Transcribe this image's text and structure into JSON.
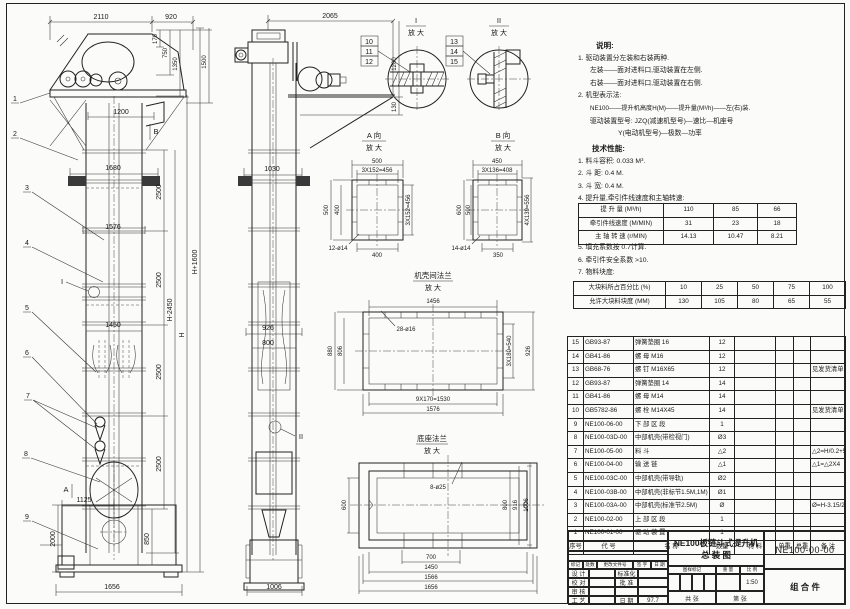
{
  "notes": {
    "title": "说明:",
    "line1": "1. 驱动装置分左装和右装两种.",
    "line2": "左装——面对进料口,驱动装置在左侧.",
    "line3": "右装——面对进料口,驱动装置在右侧.",
    "line4": "2. 机型表示法:",
    "line5": "NE100——提升机高度H(M)——提升量(M³/h)——左(右)装.",
    "line6": "驱动装置型号: JZQ(减速机型号)—速比—机座号",
    "line7": "Y(电动机型号)—极数—功率"
  },
  "tech": {
    "title": "技术性能:",
    "item1": "1. 料斗容积: 0.033 M³.",
    "item2": "2. 斗  距: 0.4 M.",
    "item3": "3. 斗  宽: 0.4 M.",
    "item4": "4. 提升量,牵引件线速度和主轴转速:",
    "item5": "5. 填充系数按 0.7计算.",
    "item6": "6. 牵引件安全系数 >10.",
    "item7": "7. 物料块度:",
    "table1": {
      "r1": {
        "label": "提 升 量  (M³/h)",
        "v1": "110",
        "v2": "85",
        "v3": "66"
      },
      "r2": {
        "label": "牵引件线速度 (M/MIN)",
        "v1": "31",
        "v2": "23",
        "v3": "18"
      },
      "r3": {
        "label": "主 轴 转 速 (r/MIN)",
        "v1": "14.13",
        "v2": "10.47",
        "v3": "8.21"
      }
    },
    "table2": {
      "r1": {
        "label": "大块料所占百分比 (%)",
        "v1": "10",
        "v2": "25",
        "v3": "50",
        "v4": "75",
        "v5": "100"
      },
      "r2": {
        "label": "允许大块料块度 (MM)",
        "v1": "130",
        "v2": "105",
        "v3": "80",
        "v4": "65",
        "v5": "55"
      }
    }
  },
  "bom": {
    "headers": {
      "no": "序号",
      "code": "代    号",
      "name": "名      称",
      "qty": "数量",
      "mat": "材    料",
      "uw": "单重",
      "tw": "总重",
      "remark": "备  注"
    },
    "rows": [
      {
        "no": "15",
        "code": "GB93-87",
        "name": "弹簧垫圈  16",
        "qty": "12",
        "mat": "",
        "uw": "",
        "tw": "",
        "remark": ""
      },
      {
        "no": "14",
        "code": "GB41-86",
        "name": "螺 母  M16",
        "qty": "12",
        "mat": "",
        "uw": "",
        "tw": "",
        "remark": ""
      },
      {
        "no": "13",
        "code": "GB68-76",
        "name": "螺 钉  M16X65",
        "qty": "12",
        "mat": "",
        "uw": "",
        "tw": "",
        "remark": "见发货清单"
      },
      {
        "no": "12",
        "code": "GB93-87",
        "name": "弹簧垫圈  14",
        "qty": "14",
        "mat": "",
        "uw": "",
        "tw": "",
        "remark": ""
      },
      {
        "no": "11",
        "code": "GB41-86",
        "name": "螺 母  M14",
        "qty": "14",
        "mat": "",
        "uw": "",
        "tw": "",
        "remark": ""
      },
      {
        "no": "10",
        "code": "GB5782-86",
        "name": "螺 栓  M14X45",
        "qty": "14",
        "mat": "",
        "uw": "",
        "tw": "",
        "remark": "见发货清单"
      },
      {
        "no": "9",
        "code": "NE100-06-00",
        "name": "下 部 区 段",
        "qty": "1",
        "mat": "",
        "uw": "",
        "tw": "",
        "remark": ""
      },
      {
        "no": "8",
        "code": "NE100-03D-00",
        "name": "中部机壳(带检视门)",
        "qty": "Ø3",
        "mat": "",
        "uw": "",
        "tw": "",
        "remark": ""
      },
      {
        "no": "7",
        "code": "NE100-05-00",
        "name": "料  斗",
        "qty": "△2",
        "mat": "",
        "uw": "",
        "tw": "",
        "remark": "△2=H/0.2+5.75"
      },
      {
        "no": "6",
        "code": "NE100-04-00",
        "name": "输 送 链",
        "qty": "△1",
        "mat": "",
        "uw": "",
        "tw": "",
        "remark": "△1=△2X4"
      },
      {
        "no": "5",
        "code": "NE100-03C-00",
        "name": "中部机壳(带导轨)",
        "qty": "Ø2",
        "mat": "",
        "uw": "",
        "tw": "",
        "remark": ""
      },
      {
        "no": "4",
        "code": "NE100-03B-00",
        "name": "中部机壳(非标节1.5M,1M)",
        "qty": "Ø1",
        "mat": "",
        "uw": "",
        "tw": "",
        "remark": ""
      },
      {
        "no": "3",
        "code": "NE100-03A-00",
        "name": "中部机壳(标准节2.5M)",
        "qty": "Ø",
        "mat": "",
        "uw": "",
        "tw": "",
        "remark": "Ø=H-3.15/2.5"
      },
      {
        "no": "2",
        "code": "NE100-02-00",
        "name": "上 部 区 段",
        "qty": "1",
        "mat": "",
        "uw": "",
        "tw": "",
        "remark": ""
      },
      {
        "no": "1",
        "code": "NE100-01-00",
        "name": "驱 动 装 置",
        "qty": "1",
        "mat": "",
        "uw": "",
        "tw": "",
        "remark": ""
      }
    ]
  },
  "title_block": {
    "product": "NE100板链斗式提升机",
    "sheet_name": "总   装   图",
    "code": "NE100-00-00",
    "part_type": "组  合  件",
    "rev_h1": "标记",
    "rev_h2": "处数",
    "rev_h3": "更改文件号",
    "rev_h4": "签 字",
    "rev_h5": "日 期",
    "l1": "设 计",
    "l2": "校 对",
    "l3": "审 核",
    "l4": "工 艺",
    "r1": "标准化",
    "r2": "批 准",
    "r3": "日 期",
    "date": "97.7",
    "m1": "图样标记",
    "m2": "重 量",
    "m3": "比 例",
    "scale": "1:50",
    "sheet_count": "共  张",
    "sheet_no": "第  张"
  },
  "dims": {
    "enlarge": "放 大",
    "view1": {
      "top": "2110",
      "top2": "920",
      "head_r1": "170",
      "head_r2": "750",
      "head_r3": "1350",
      "head_r4": "1500",
      "inlet": "1200",
      "w1": "1680",
      "w2": "1576",
      "w3": "1450",
      "seg1": "2500",
      "seg2": "2500",
      "seg3": "2500",
      "seg4": "2500",
      "seg5": "850",
      "h1": "H-2450",
      "h2": "H",
      "h3": "H+1600",
      "b1": "1125",
      "b2": "2000",
      "bw": "1656",
      "mark_b": "B",
      "mark_a": "A",
      "detail": "I",
      "balloons": [
        "1",
        "2",
        "3",
        "4",
        "5",
        "6",
        "7",
        "8",
        "9"
      ]
    },
    "view2": {
      "top": "2065",
      "r1": "1200",
      "r2": "130",
      "w1": "1030",
      "w2": "926",
      "w3": "800",
      "bw": "1006",
      "detail": "II"
    },
    "detail_i": {
      "label": "I",
      "parts": [
        "10",
        "11",
        "12"
      ]
    },
    "detail_ii": {
      "label": "II",
      "parts": [
        "13",
        "14",
        "15"
      ]
    },
    "view_a": {
      "label": "A 向",
      "top": "500",
      "top2": "3X152=456",
      "left": "500",
      "left2": "400",
      "right": "3X152=456",
      "bottom": "400",
      "holes": "12-ø14"
    },
    "view_b": {
      "label": "B 向",
      "top": "450",
      "top2": "3X136=408",
      "left": "600",
      "left2": "500",
      "right": "4X139=556",
      "bottom": "350",
      "holes": "14-ø14"
    },
    "flange": {
      "label": "机壳间法兰",
      "top": "1456",
      "holes": "28-ø16",
      "left": "880",
      "left2": "806",
      "right": "3X180=540",
      "right2": "926",
      "bottom": "9X170=1530",
      "bottom2": "1576"
    },
    "base": {
      "label": "底座法兰",
      "holes": "8-ø25",
      "left": "600",
      "right": "800",
      "right2": "916",
      "right3": "1006",
      "bottom": "700",
      "bottom2": "1450",
      "bottom3": "1566",
      "bottom4": "1656"
    }
  }
}
